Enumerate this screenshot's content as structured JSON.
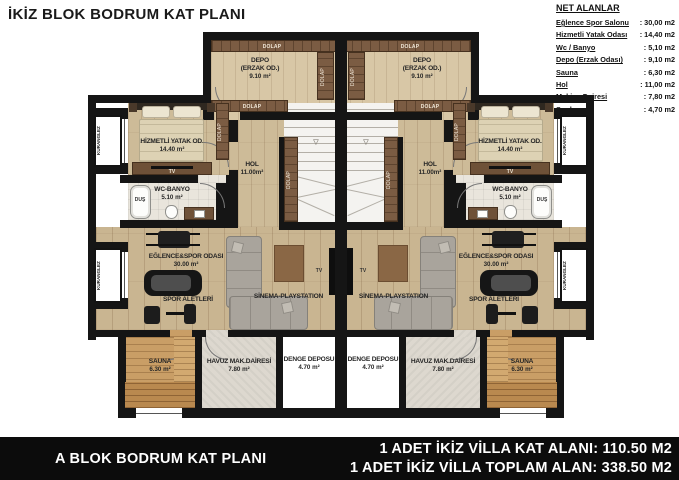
{
  "header": {
    "title": "İKİZ BLOK BODRUM KAT PLANI"
  },
  "legend": {
    "title": "NET ALANLAR",
    "items": [
      {
        "name": "Eğlence Spor Salonu",
        "value": ": 30,00  m2"
      },
      {
        "name": "Hizmetli Yatak Odası",
        "value": ": 14,40  m2"
      },
      {
        "name": "Wc / Banyo",
        "value": ": 5,10  m2"
      },
      {
        "name": "Depo (Erzak Odası)",
        "value": ": 9,10  m2"
      },
      {
        "name": "Sauna",
        "value": ": 6,30  m2"
      },
      {
        "name": "Hol",
        "value": ": 11,00  m2"
      },
      {
        "name": "Makina Dairesi",
        "value": ": 7,80  m2"
      },
      {
        "name": "Su deposu",
        "value": ": 4,70  m2"
      }
    ]
  },
  "plan": {
    "rooms": {
      "depo": {
        "line1": "DEPO",
        "line2": "(ERZAK OD.)",
        "area": "9.10 m²"
      },
      "bedroom": {
        "name": "HİZMETLİ YATAK OD.",
        "area": "14.40 m²"
      },
      "wc": {
        "name": "WC-BANYO",
        "area": "5.10 m²"
      },
      "hol": {
        "name": "HOL",
        "area": "11.00m²"
      },
      "sport": {
        "name": "EĞLENCE&SPOR ODASI",
        "area": "30.00 m²"
      },
      "sauna": {
        "name": "SAUNA",
        "area": "6.30 m²"
      },
      "havuz": {
        "name": "HAVUZ MAK.DAİRESİ",
        "area": "7.80 m²"
      },
      "denge": {
        "name": "DENGE DEPOSU",
        "area": "4.70 m²"
      }
    },
    "labels": {
      "dolap": "DOLAP",
      "kuranglez": "KURANGLEZ",
      "dus": "DUŞ",
      "tv": "TV",
      "spor_aletleri": "SPOR ALETLERİ",
      "sinema": "SİNEMA-PLAYSTATION"
    },
    "colors": {
      "wall": "#151515",
      "wood_floor": "#cdbb98",
      "cabinet_wood": "#7b5c43",
      "sauna_wood": "#c99e66",
      "concrete": "#ddd8cf",
      "sofa": "#a9a49c",
      "rug": "#8a6745",
      "footer_bg": "#0c0c0c"
    }
  },
  "footer": {
    "left": "A BLOK BODRUM KAT PLANI",
    "line1": "1 ADET İKİZ VİLLA KAT ALANI: 110.50 M2",
    "line2": "1 ADET İKİZ VİLLA TOPLAM ALAN: 338.50 M2"
  }
}
